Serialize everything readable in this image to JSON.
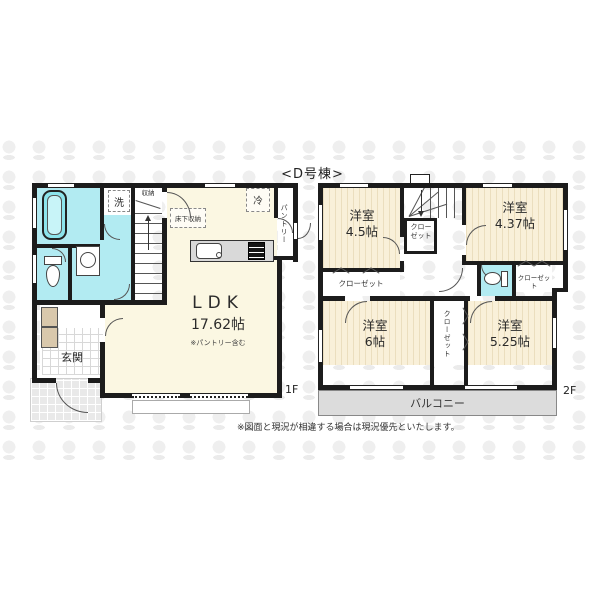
{
  "title": "<D号棟>",
  "disclaimer": "※図面と現況が相違する場合は現況優先といたします。",
  "floor1": {
    "label": "1F",
    "ldk": {
      "name": "LDK",
      "size": "17.62帖",
      "note": "※パントリー含む"
    },
    "entrance": "玄関",
    "laundry": "洗",
    "stair_storage": "収納",
    "underfloor_storage": "床下収納",
    "fridge": "冷",
    "pantry": "パントリー"
  },
  "floor2": {
    "label": "2F",
    "room_nw": {
      "name": "洋室",
      "size": "4.5帖"
    },
    "room_ne": {
      "name": "洋室",
      "size": "4.37帖"
    },
    "room_sw": {
      "name": "洋室",
      "size": "6帖"
    },
    "room_se": {
      "name": "洋室",
      "size": "5.25帖"
    },
    "closet_nw": "クローゼット",
    "closet_ne": "クローゼット",
    "closet_under_stairs": "クローゼット",
    "closet_center": "クローゼット",
    "toilet": "",
    "balcony": "バルコニー"
  },
  "colors": {
    "wall": "#1c1c1c",
    "room_cream": "#fbf7e2",
    "room_wood": "#f9f0d9",
    "wet_area": "#b2ebf2",
    "balcony_gray": "#dcdcdc"
  }
}
